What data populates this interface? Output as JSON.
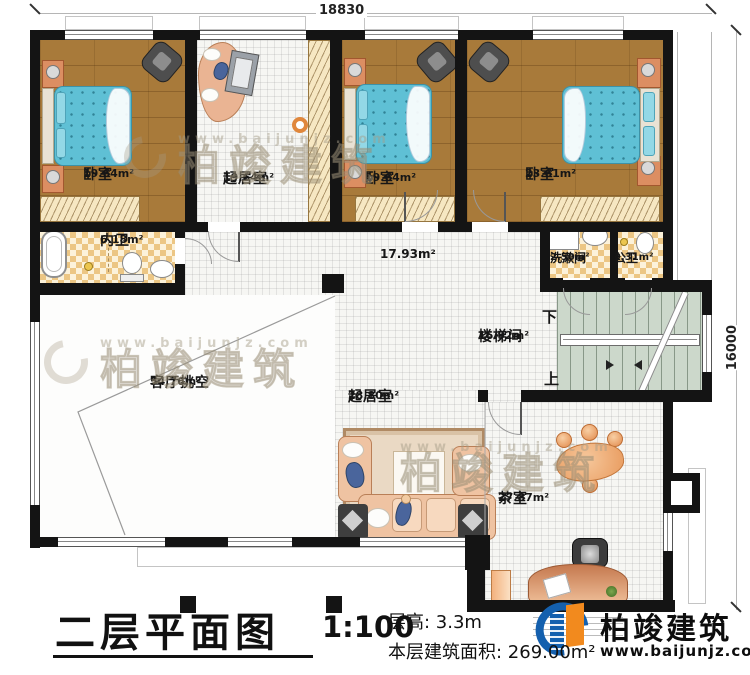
{
  "dimensions": {
    "width_top": "18830",
    "height_right": "16000"
  },
  "rooms": {
    "bedroom_left": {
      "name": "卧室",
      "area": "19.64m²"
    },
    "sitting_top": {
      "name": "起居室",
      "area": "19.64m²"
    },
    "bedroom_mid": {
      "name": "卧室",
      "area": "19.64m²"
    },
    "bedroom_right": {
      "name": "卧室",
      "area": "23.61m²"
    },
    "inner_bath": {
      "name": "内卫",
      "area": "6.18m²"
    },
    "hallway": {
      "area": "17.93m²"
    },
    "washroom": {
      "name": "洗漱间",
      "area": "2.50m²"
    },
    "public_bath": {
      "name": "公卫",
      "area": "2.31m²"
    },
    "stairwell": {
      "name": "楼梯间",
      "area": "16.92m²",
      "down_label": "下",
      "up_label": "上"
    },
    "living_void": {
      "name": "客厅挑空",
      "area": "54.76m²"
    },
    "sitting_bottom": {
      "name": "起居室",
      "area": "28.80m²"
    },
    "tea_room": {
      "name": "茶室",
      "area": "27.87m²"
    }
  },
  "footer": {
    "title": "二层平面图",
    "scale": "1:100",
    "floor_height": "层高: 3.3m",
    "floor_area": "本层建筑面积: 269.00m²"
  },
  "brand": {
    "name": "柏竣建筑",
    "url": "www.baijunjz.com"
  }
}
